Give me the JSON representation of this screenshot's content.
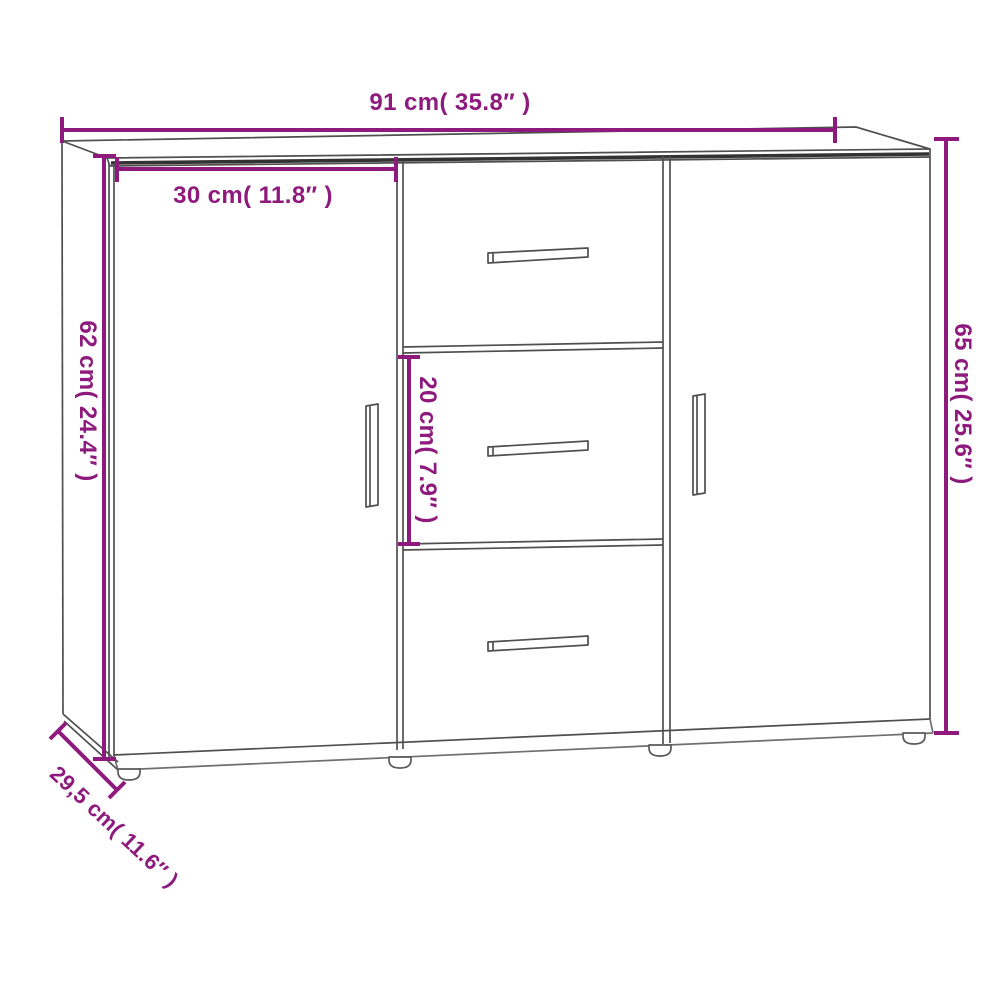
{
  "page": {
    "background_color": "#FFFFFF"
  },
  "diagram": {
    "subject": "sideboard with two doors and three drawers",
    "accent_color": "#8E1A7D",
    "line_color": "#4F4F4F",
    "dimensions": {
      "overall_width": {
        "cm": "91",
        "inch": "35.8",
        "label": "91 cm( 35.8″ )"
      },
      "door_width": {
        "cm": "30",
        "inch": "11.8",
        "label": "30 cm( 11.8″ )"
      },
      "body_height": {
        "cm": "62",
        "inch": "24.4",
        "label": "62 cm( 24.4″ )"
      },
      "overall_height": {
        "cm": "65",
        "inch": "25.6",
        "label": "65 cm( 25.6″ )"
      },
      "drawer_height": {
        "cm": "20",
        "inch": "7.9",
        "label": "20 cm( 7.9″ )"
      },
      "depth": {
        "cm": "29,5",
        "inch": "11.6",
        "label": "29,5 cm( 11.6″ )"
      }
    }
  }
}
